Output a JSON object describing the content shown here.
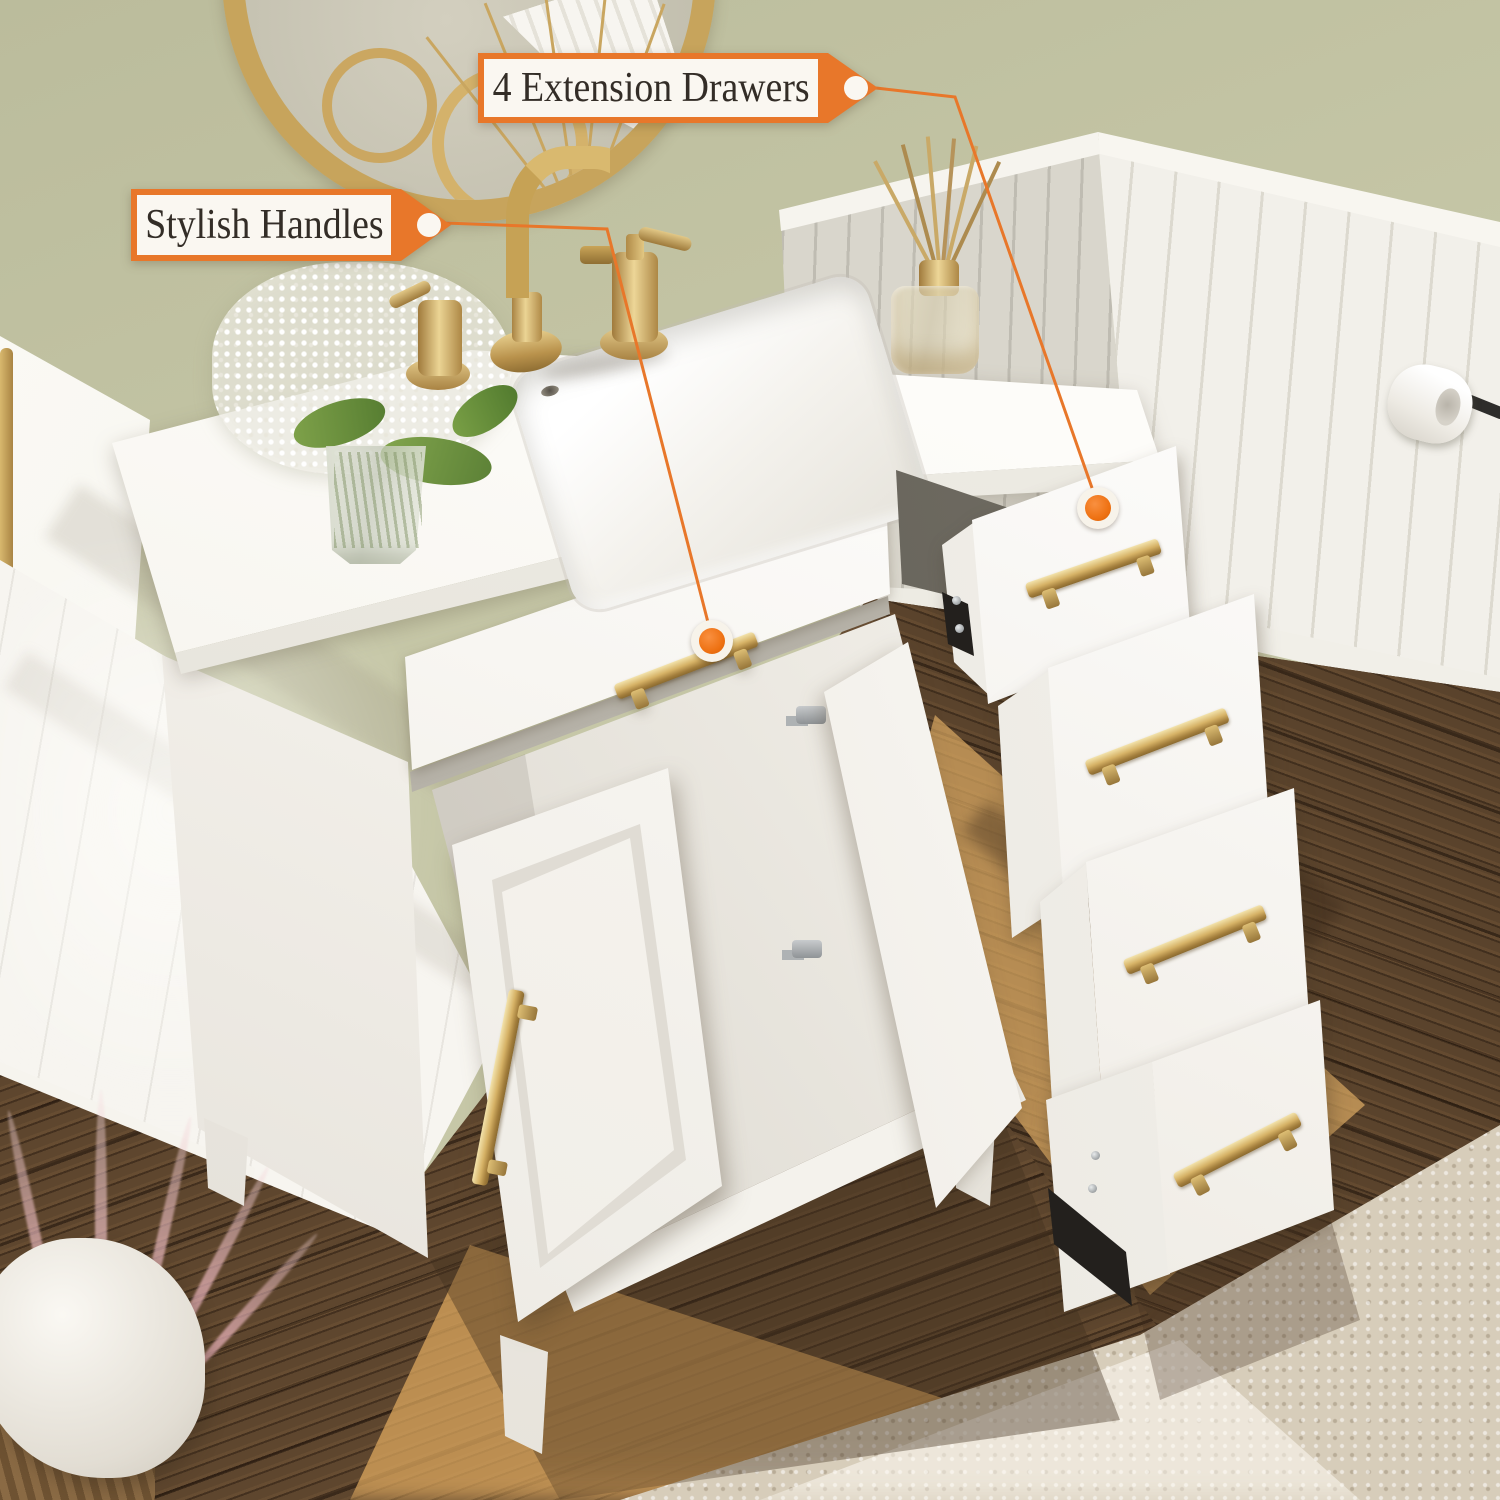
{
  "image_type": "annotated product photo",
  "subject": "white bathroom vanity with gold hardware, open doors and four pulled-out side drawers",
  "callouts": {
    "extension_drawers": {
      "label": "4 Extension Drawers"
    },
    "stylish_handles": {
      "label": "Stylish Handles"
    }
  },
  "palette": {
    "accent_orange": "#E8772A",
    "dot_orange": "#EE7112",
    "tag_bg": "#FAF7F1",
    "tag_text": "#332D27",
    "wall_green": "#C6C7A7",
    "gold": "#C9A558",
    "wood_dark": "#5E462E",
    "rug_beige": "#D7CDBA"
  }
}
